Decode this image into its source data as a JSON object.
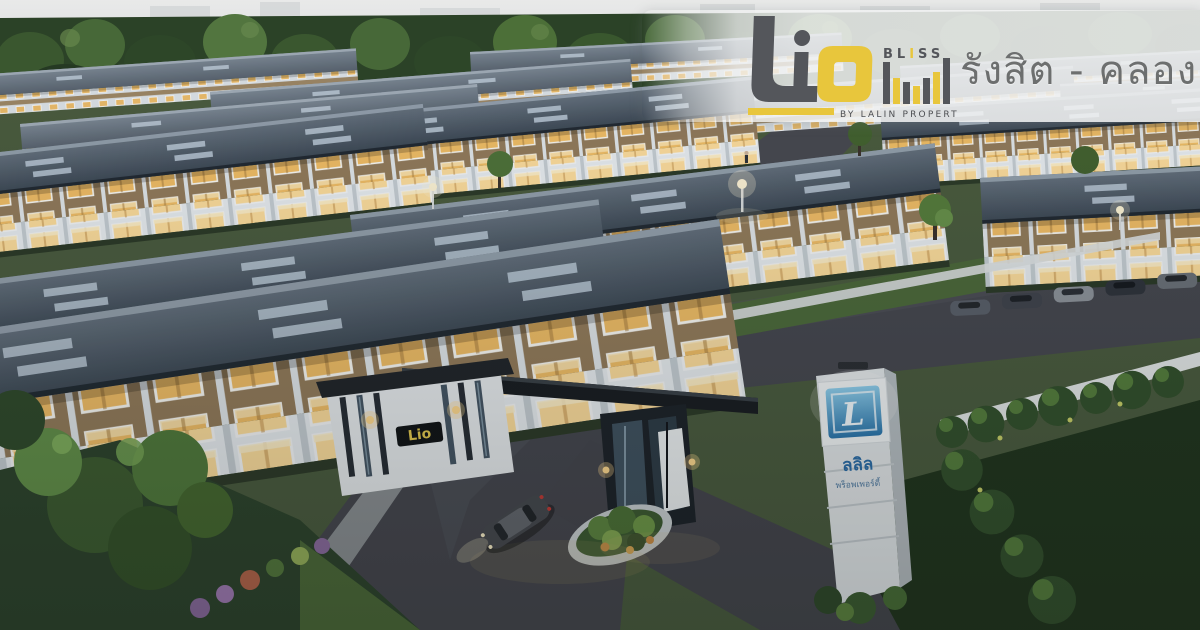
{
  "page": {
    "title": "Lio Bliss รังสิต - คลอง 4"
  },
  "overlay": {
    "brand_word": "Lio",
    "brand_sub_pre": "BL",
    "brand_sub_i": "I",
    "brand_sub_post": "SS",
    "byline": "BY LALIN PROPERTY",
    "location": "รังสิต - คลอง 4"
  },
  "scene": {
    "gate_sign": "Lio",
    "pylon_monogram": "L",
    "pylon_thai_name": "ลลิล",
    "pylon_thai_sub": "พร็อพเพอร์ตี้"
  },
  "colors": {
    "accent_yellow": "#e8c63c",
    "brand_gray": "#54565b",
    "location_text": "#6d6f6f",
    "pylon_blue": "#3287be",
    "roof_slate": "#46525f",
    "window_glow": "#f2bf66"
  }
}
